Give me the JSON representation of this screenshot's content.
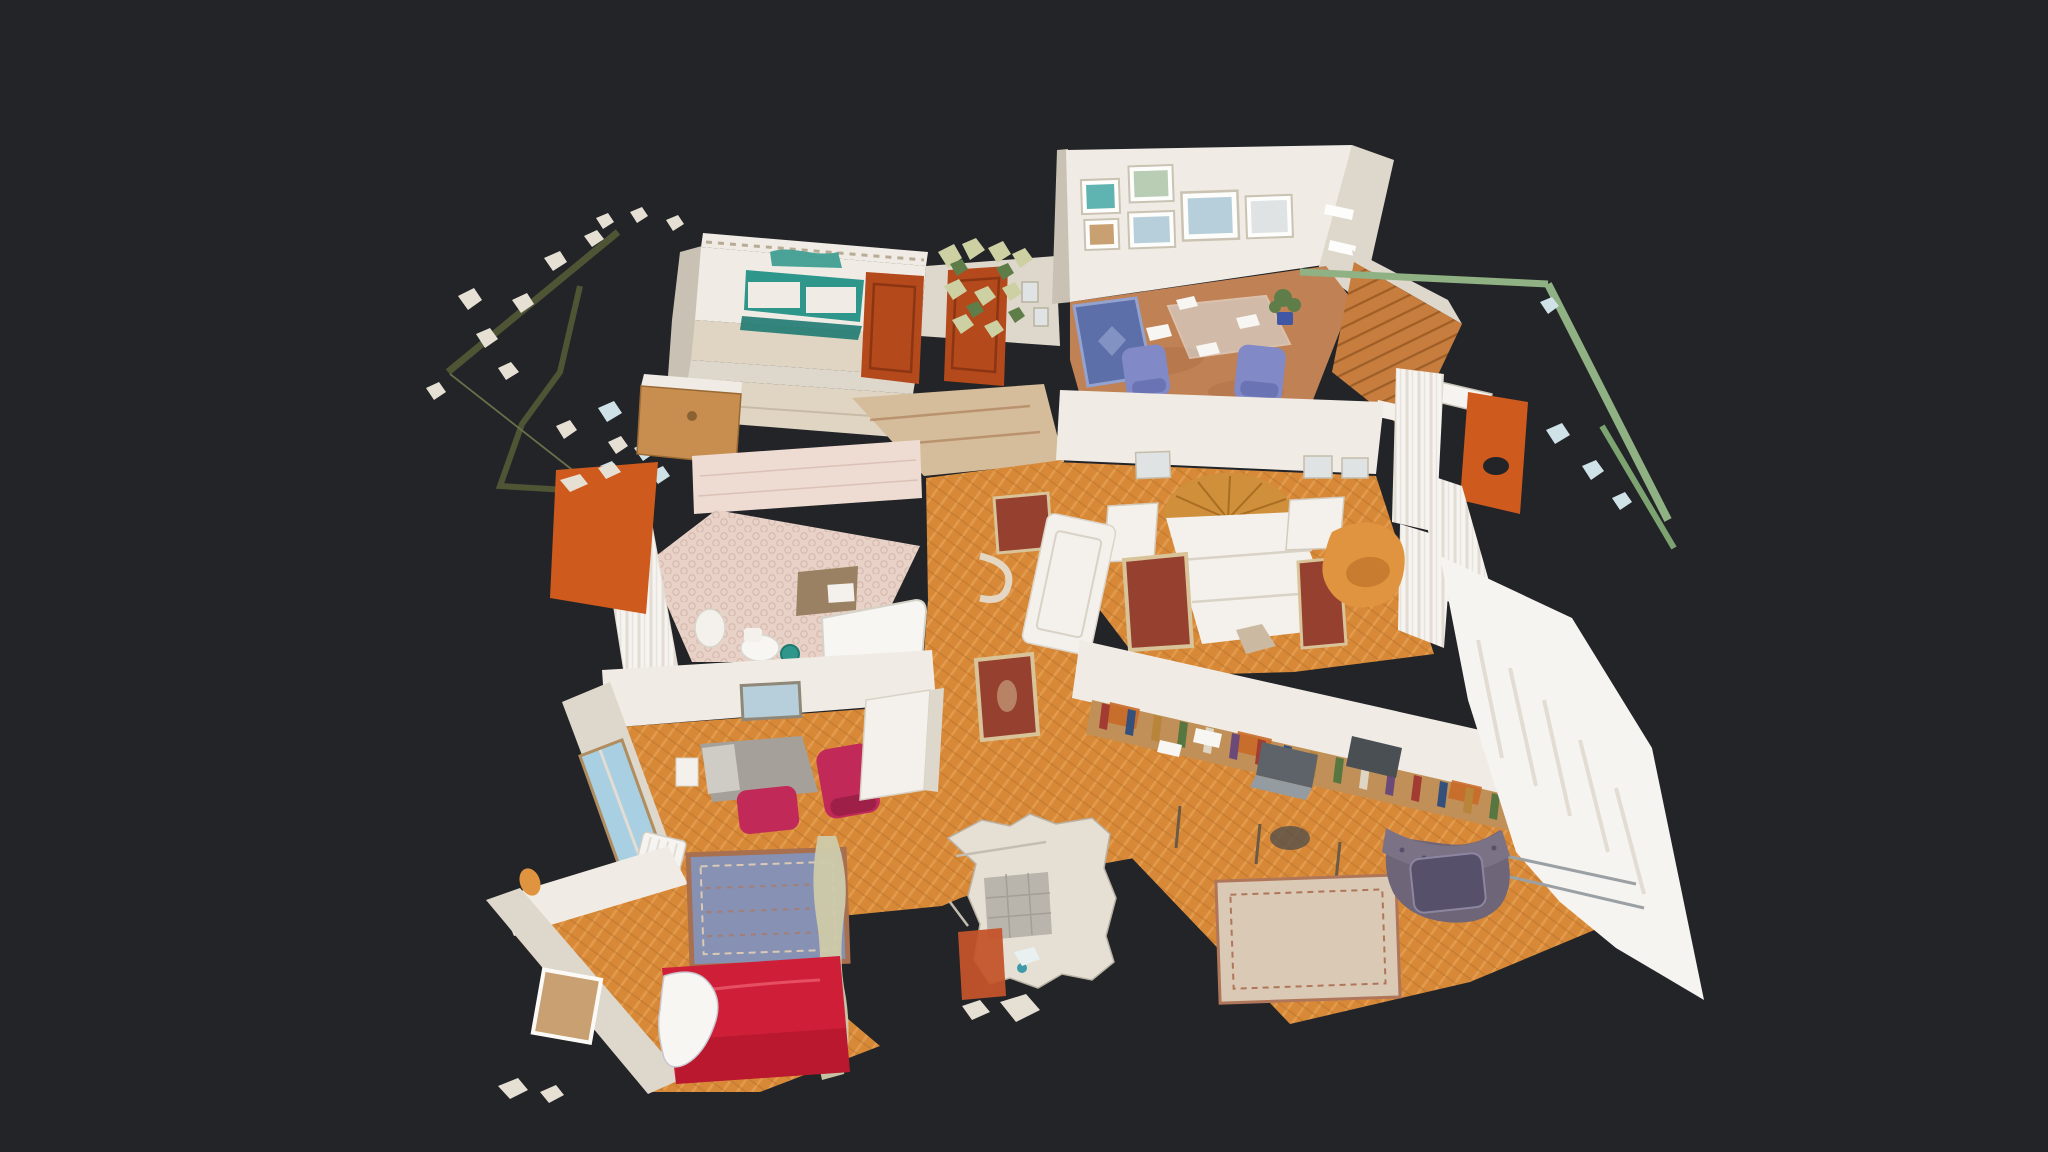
{
  "app": {
    "name": "3D property scan viewer",
    "view_mode": "dollhouse",
    "background_color": "#232428"
  },
  "scene": {
    "description": "Overhead cutaway dollhouse view of a scanned apartment with herringbone parquet hallway, two balconies with railings and visible scan-mesh debris around the model edges",
    "rooms": [
      {
        "name": "Kitchen",
        "features": [
          "teal backsplash",
          "white cabinets",
          "wood cabinet door"
        ]
      },
      {
        "name": "Entry hall",
        "features": [
          "two rust-red doors",
          "shelf with plants",
          "beige floor"
        ]
      },
      {
        "name": "Dining room",
        "features": [
          "six framed pictures",
          "glass table",
          "blue upholstered chairs",
          "blue rug",
          "terracotta floor",
          "potted plant"
        ]
      },
      {
        "name": "Right balcony",
        "features": [
          "wood plank deck",
          "green railing",
          "orange panel"
        ]
      },
      {
        "name": "Main bedroom",
        "features": [
          "double bed",
          "sunburst wood headboard",
          "two nightstands",
          "red oriental rugs",
          "orange armchair",
          "white curtains"
        ]
      },
      {
        "name": "Bathroom",
        "features": [
          "pink hex-tile floor",
          "bathtub",
          "toilet",
          "teal bucket",
          "shower curtain",
          "orange panel"
        ]
      },
      {
        "name": "Second bedroom",
        "features": [
          "grey bed",
          "magenta chair",
          "magenta ottoman",
          "window",
          "radiator"
        ]
      },
      {
        "name": "Living room",
        "features": [
          "red sofa",
          "white blanket",
          "blue oriental rug",
          "framed picture"
        ]
      },
      {
        "name": "Study",
        "features": [
          "long desk",
          "bookshelf with books",
          "laptop",
          "printer",
          "purple tufted armchair",
          "pale rug",
          "curtained window wall"
        ]
      },
      {
        "name": "Hallway",
        "features": [
          "herringbone parquet",
          "small oriental rugs",
          "leaning white door"
        ]
      },
      {
        "name": "Left balcony",
        "features": [
          "olive railing",
          "scan debris fragments"
        ]
      },
      {
        "name": "Torn scan area",
        "features": [
          "grey tile patch",
          "orange fragment",
          "silver shards"
        ]
      }
    ],
    "colors": {
      "background": "#232428",
      "wall": "#f0ece5",
      "wall_shade": "#ded7cb",
      "wall_dark": "#c9c1b3",
      "trim": "#b8ab96",
      "parquet": "#d78938",
      "parquet_light": "#eaa95c",
      "parquet_dark": "#b96f28",
      "terracotta": "#c08254",
      "terracotta_dark": "#a2683f",
      "entry_floor": "#d5bd9c",
      "kitchen_floor": "#e0d5c2",
      "tile_pink": "#e8d2c7",
      "tile_dot": "#d3b6aa",
      "bath_wall": "#eedbd2",
      "teal": "#2e968b",
      "teal_dark": "#1f7a72",
      "door_rust": "#b4491c",
      "door_rust_dark": "#8c3512",
      "door_wood": "#c78e50",
      "orange_panel": "#cf5a1d",
      "sofa_red": "#cf1f38",
      "sofa_red_dark": "#a81227",
      "chair_magenta": "#c12a58",
      "chair_magenta_dark": "#9e2048",
      "dining_blue": "#8289c7",
      "dining_blue_dark": "#6a74b4",
      "rug_blue": "#5d6fa9",
      "rug_blue_light": "#93a2cf",
      "rug_red": "#96412f",
      "rug_border": "#d9c49a",
      "rug_pale": "#d9c9b5",
      "rug_pale_motif": "#b0765a",
      "living_rug": "#8691b4",
      "living_rug_border": "#a8704f",
      "armchair_orange": "#e09440",
      "armchair_orange_dark": "#c1752a",
      "armchair_purple": "#6e6579",
      "armchair_purple_light": "#7b7286",
      "cushion_purple": "#57506b",
      "railing_olive": "#4f5435",
      "railing_olive_thin": "#6a6f4a",
      "railing_green": "#8fb183",
      "railing_green_dark": "#7da371",
      "deck_wood": "#c67d3e",
      "deck_line": "#a05e27",
      "headboard": "#d08f3b",
      "headboard_ray": "#a86e22",
      "bed_white": "#f4f1ec",
      "bed_shadow": "#d9d2c6",
      "grey_bed": "#a5a09a",
      "grey_bed_light": "#cfccc6",
      "curtain": "#f6f4f0",
      "curtain_line": "#e2dcd2",
      "glass": "#dfe9ec",
      "plant": "#5f7d48",
      "plant_pale": "#cdd0a2",
      "pot_blue": "#3f57a4",
      "sky": "#a8cfe2",
      "pic_blue": "#b7cfda",
      "pic_teal": "#5fb3b0",
      "pic_tan": "#c8a071",
      "pic_green": "#b9cdb4",
      "pic_pale": "#dfe3e4",
      "frame_white": "#fdfdfb",
      "frame_stroke": "#cac2b2",
      "debris": "#e6e0d4",
      "debris_pale_blue": "#cfe2e8",
      "debris_sage": "#cfcbaa",
      "paper": "#f7f6f2",
      "shelf_wood": "#c09058",
      "shelf_inner": "#c96a28",
      "appliance_grey": "#5d6368",
      "appliance_light": "#949ca2",
      "printer_dark": "#4a4f54",
      "book_red": "#a23b32",
      "book_blue": "#35507a",
      "book_green": "#58763f",
      "book_tan": "#b8853a",
      "book_purple": "#6b4a7a",
      "book_cream": "#ded6c2",
      "tile_grey": "#b9b4ac",
      "torn_orange": "#c4542a",
      "wood_leg": "#6b5b45"
    }
  }
}
